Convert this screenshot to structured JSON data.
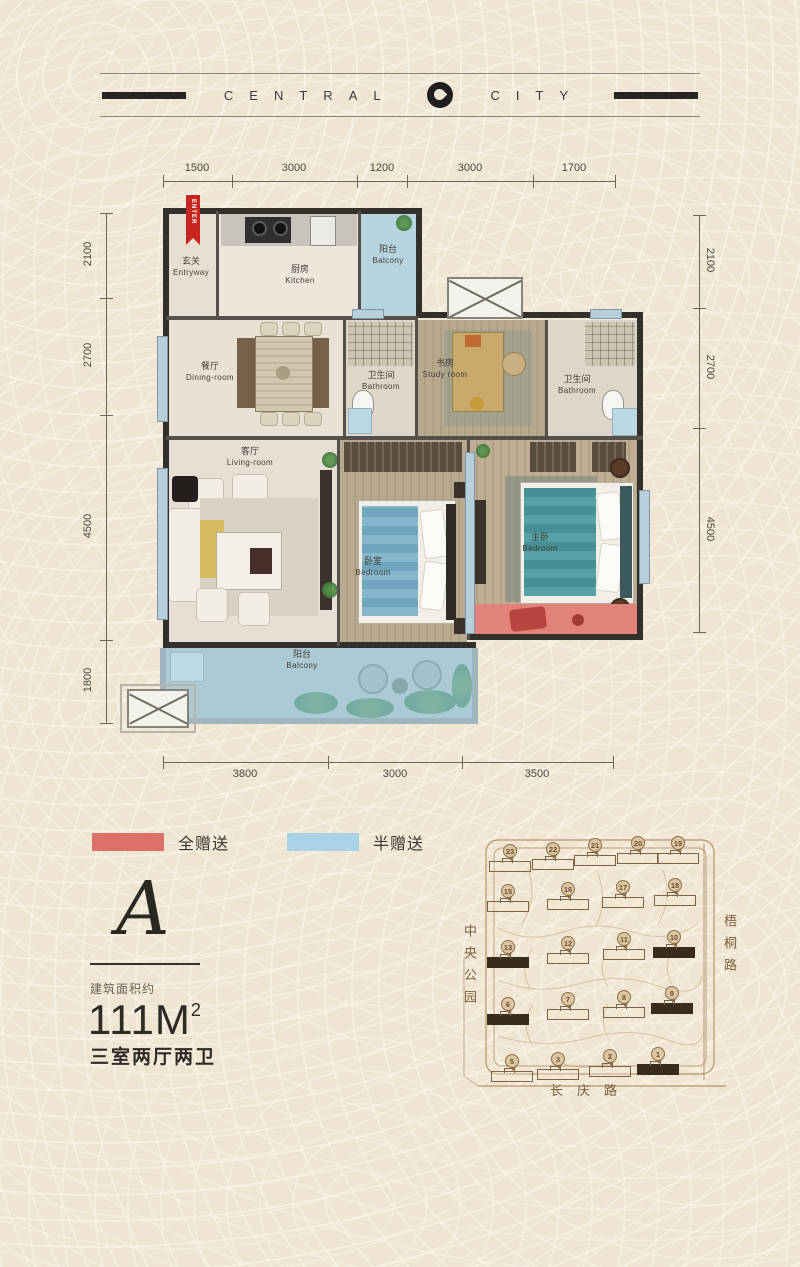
{
  "header": {
    "brand_left": "CENTRAL",
    "brand_right": "CITY"
  },
  "floor_plan": {
    "enter_label": "ENTER",
    "dimensions": {
      "top": [
        "1500",
        "3000",
        "1200",
        "3000",
        "1700"
      ],
      "bottom": [
        "3800",
        "3000",
        "3500"
      ],
      "left": [
        "2100",
        "2700",
        "4500",
        "1800"
      ],
      "right": [
        "2100",
        "2700",
        "4500"
      ]
    },
    "rooms": [
      {
        "zh": "玄关",
        "en": "Entryway",
        "x": 31,
        "y": 62
      },
      {
        "zh": "厨房",
        "en": "Kitchen",
        "x": 140,
        "y": 70
      },
      {
        "zh": "阳台",
        "en": "Balcony",
        "x": 228,
        "y": 50
      },
      {
        "zh": "餐厅",
        "en": "Dining-room",
        "x": 50,
        "y": 167
      },
      {
        "zh": "卫生间",
        "en": "Bathroom",
        "x": 221,
        "y": 176
      },
      {
        "zh": "书房",
        "en": "Study room",
        "x": 285,
        "y": 164
      },
      {
        "zh": "卫生间",
        "en": "Bathroom",
        "x": 417,
        "y": 180
      },
      {
        "zh": "客厅",
        "en": "Living-room",
        "x": 90,
        "y": 252
      },
      {
        "zh": "卧室",
        "en": "Bedroom",
        "x": 213,
        "y": 362
      },
      {
        "zh": "主卧",
        "en": "Bedroom",
        "x": 380,
        "y": 338
      },
      {
        "zh": "阳台",
        "en": "Balcony",
        "x": 142,
        "y": 455
      }
    ]
  },
  "legend": [
    {
      "label": "全赠送",
      "color": "#dc7168"
    },
    {
      "label": "半赠送",
      "color": "#a8d3e7"
    }
  ],
  "unit_info": {
    "type_letter": "A",
    "area_prefix": "建筑面积约",
    "area_value": "111M",
    "area_sup": "2",
    "layout": "三室两厅两卫"
  },
  "site_map": {
    "park_label": "中央公园",
    "right_road": "梧桐路",
    "bottom_road": "长庆路",
    "buildings": [
      {
        "n": "23",
        "x": 52,
        "y": 24,
        "dark": false
      },
      {
        "n": "22",
        "x": 95,
        "y": 22,
        "dark": false
      },
      {
        "n": "21",
        "x": 137,
        "y": 18,
        "dark": false
      },
      {
        "n": "20",
        "x": 180,
        "y": 16,
        "dark": false
      },
      {
        "n": "19",
        "x": 220,
        "y": 16,
        "dark": false
      },
      {
        "n": "15",
        "x": 50,
        "y": 64,
        "dark": false
      },
      {
        "n": "16",
        "x": 110,
        "y": 62,
        "dark": false
      },
      {
        "n": "17",
        "x": 165,
        "y": 60,
        "dark": false
      },
      {
        "n": "18",
        "x": 217,
        "y": 58,
        "dark": false
      },
      {
        "n": "13",
        "x": 50,
        "y": 120,
        "dark": true
      },
      {
        "n": "12",
        "x": 110,
        "y": 116,
        "dark": false
      },
      {
        "n": "11",
        "x": 166,
        "y": 112,
        "dark": false
      },
      {
        "n": "10",
        "x": 216,
        "y": 110,
        "dark": true
      },
      {
        "n": "6",
        "x": 50,
        "y": 177,
        "dark": true
      },
      {
        "n": "7",
        "x": 110,
        "y": 172,
        "dark": false
      },
      {
        "n": "8",
        "x": 166,
        "y": 170,
        "dark": false
      },
      {
        "n": "9",
        "x": 214,
        "y": 166,
        "dark": true
      },
      {
        "n": "5",
        "x": 54,
        "y": 234,
        "dark": false
      },
      {
        "n": "3",
        "x": 100,
        "y": 232,
        "dark": false
      },
      {
        "n": "2",
        "x": 152,
        "y": 229,
        "dark": false
      },
      {
        "n": "1",
        "x": 200,
        "y": 227,
        "dark": true
      }
    ]
  }
}
